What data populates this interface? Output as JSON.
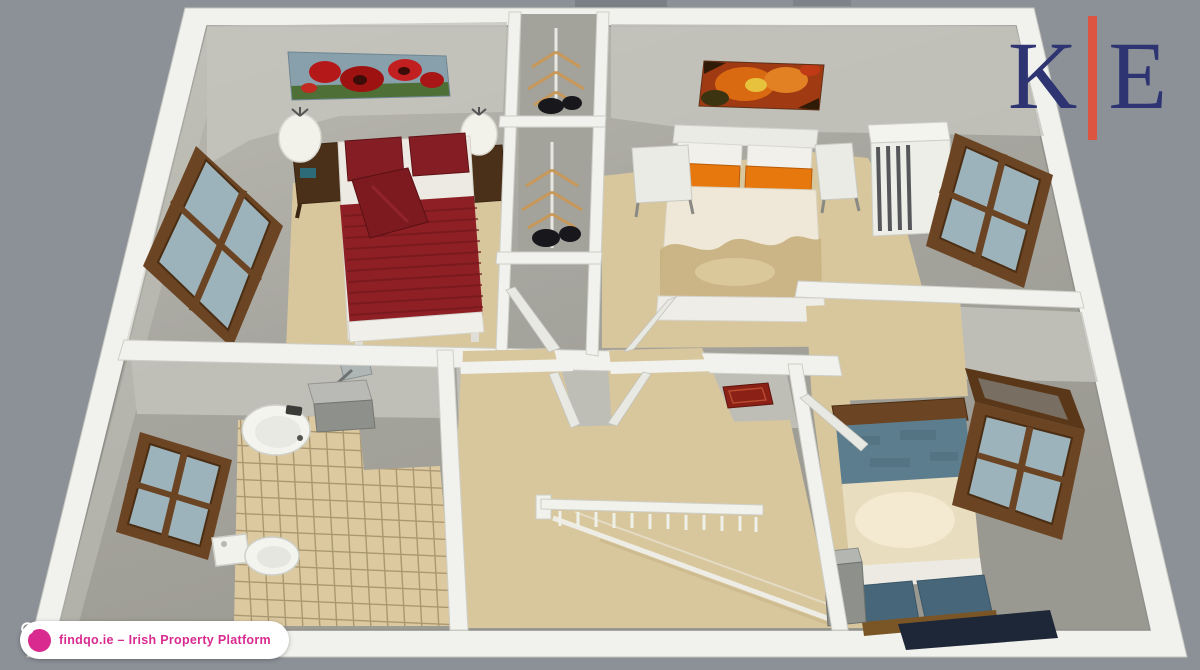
{
  "branding": {
    "logo": {
      "left": "K",
      "right": "E"
    },
    "badge": {
      "text": "findqo.ie – Irish Property Platform",
      "icon": "globe-icon"
    }
  },
  "palette": {
    "bg": "#8b9197",
    "wall": "#f1f1ed",
    "wall_edge": "#d2d2cc",
    "wall_face": "#c6c6be",
    "floor_light": "#bcbbb3",
    "floor": "#a6a59e",
    "floor_dark": "#98978f",
    "carpet": "#d8c69c",
    "tile": "#dcc9a0",
    "tile_line": "#8a7854",
    "wood": "#6b4423",
    "wood_dark": "#4a2e13",
    "glass": "#9db3bc",
    "bed_red": "#8e2025",
    "bed_red_dark": "#6f171c",
    "pillow_red": "#851e24",
    "sheet": "#eceae2",
    "orange": "#e6780e",
    "cream": "#efe8d8",
    "gold": "#c8b282",
    "white_furniture": "#ebebe5",
    "teal": "#5c7d8d",
    "teal_dark": "#47667a",
    "navy_shadow": "#1d2737",
    "nightstand": "#4a3018",
    "metal_gray": "#8e908c",
    "rug_red": "#8a2016",
    "logo_letter": "#2e3472",
    "logo_divider": "#dd5540",
    "badge_accent": "#d92a8f",
    "badge_bg": "#ffffff"
  }
}
